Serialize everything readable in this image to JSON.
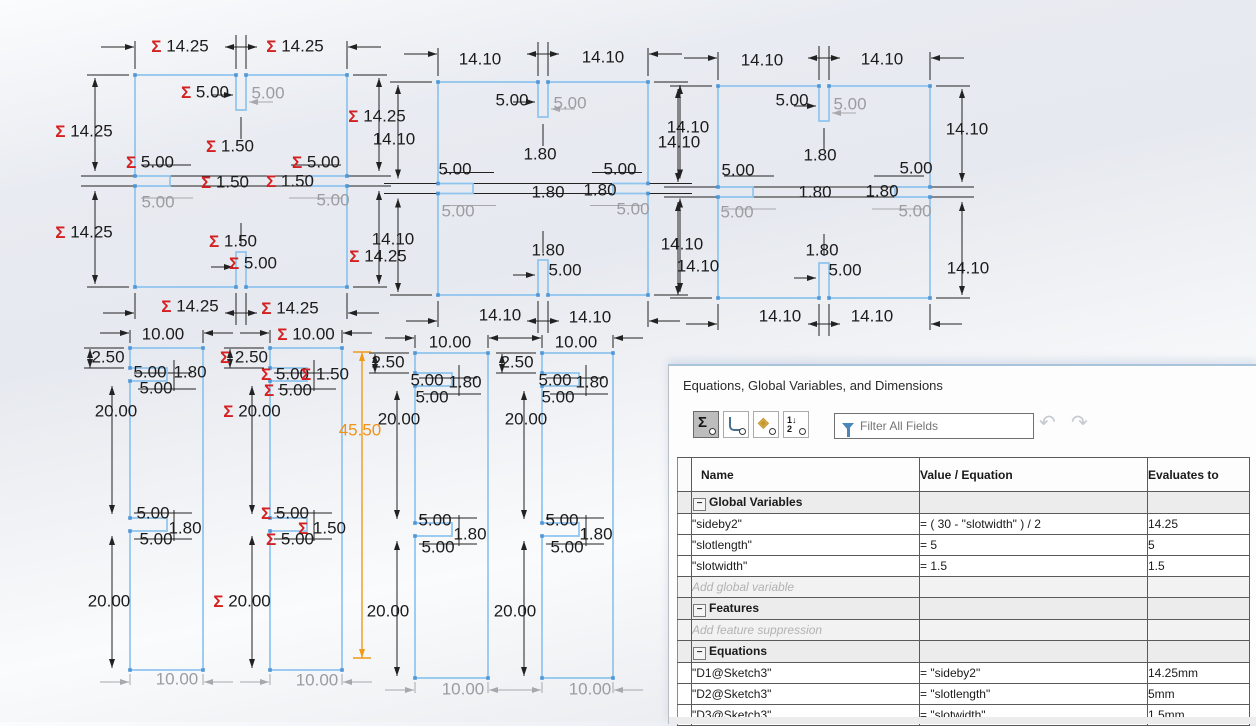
{
  "sketch": {
    "colors": {
      "sketch_blue": "#8fc4ee",
      "dim_black": "#222222",
      "dim_gray": "#a8a8ac",
      "sigma_red": "#d42020",
      "driven_orange": "#ef9318"
    },
    "squares": [
      {
        "x": 135,
        "y": 75,
        "w": 212,
        "h": 212
      },
      {
        "x": 438,
        "y": 82,
        "w": 210,
        "h": 213
      },
      {
        "x": 718,
        "y": 86,
        "w": 212,
        "h": 212
      }
    ],
    "columns": [
      {
        "x": 130,
        "y": 348,
        "w": 73,
        "h": 322
      },
      {
        "x": 270,
        "y": 348,
        "w": 72,
        "h": 322
      },
      {
        "x": 415,
        "y": 353,
        "w": 73,
        "h": 325
      },
      {
        "x": 542,
        "y": 353,
        "w": 71,
        "h": 325
      }
    ],
    "extra_lines": [
      [
        362,
        352,
        362,
        658,
        3,
        "o"
      ],
      [
        353,
        352,
        371,
        352,
        0,
        "o"
      ],
      [
        353,
        658,
        371,
        658,
        0,
        "o"
      ]
    ],
    "labels": [
      [
        180,
        46,
        "14.25",
        "s"
      ],
      [
        295,
        46,
        "14.25",
        "s"
      ],
      [
        205,
        92,
        "5.00",
        "s"
      ],
      [
        268,
        93,
        "5.00",
        "g"
      ],
      [
        84,
        131,
        "14.25",
        "s"
      ],
      [
        150,
        162,
        "5.00",
        "s"
      ],
      [
        230,
        146,
        "1.50",
        "s"
      ],
      [
        316,
        162,
        "5.00",
        "s"
      ],
      [
        225,
        182,
        "1.50",
        "s"
      ],
      [
        290,
        181,
        "1.50",
        "s"
      ],
      [
        158,
        202,
        "5.00",
        "g"
      ],
      [
        333,
        200,
        "5.00",
        "g"
      ],
      [
        84,
        232,
        "14.25",
        "s"
      ],
      [
        233,
        241,
        "1.50",
        "s"
      ],
      [
        253,
        263,
        "5.00",
        "s"
      ],
      [
        190,
        306,
        "14.25",
        "s"
      ],
      [
        290,
        308,
        "14.25",
        "s"
      ],
      [
        377,
        116,
        "14.25",
        "s"
      ],
      [
        394,
        139,
        "14.10",
        "k"
      ],
      [
        393,
        239,
        "14.10",
        "k"
      ],
      [
        378,
        256,
        "14.25",
        "s"
      ],
      [
        480,
        59,
        "14.10",
        "k"
      ],
      [
        603,
        57,
        "14.10",
        "k"
      ],
      [
        512,
        100,
        "5.00",
        "k"
      ],
      [
        570,
        103,
        "5.00",
        "g"
      ],
      [
        540,
        154,
        "1.80",
        "k"
      ],
      [
        455,
        169,
        "5.00",
        "k"
      ],
      [
        620,
        169,
        "5.00",
        "k"
      ],
      [
        548,
        192,
        "1.80",
        "k"
      ],
      [
        600,
        190,
        "1.80",
        "k"
      ],
      [
        458,
        211,
        "5.00",
        "g"
      ],
      [
        633,
        209,
        "5.00",
        "g"
      ],
      [
        548,
        250,
        "1.80",
        "k"
      ],
      [
        565,
        270,
        "5.00",
        "k"
      ],
      [
        500,
        315,
        "14.10",
        "k"
      ],
      [
        590,
        317,
        "14.10",
        "k"
      ],
      [
        688,
        127,
        "14.10",
        "k"
      ],
      [
        679,
        142,
        "14.10",
        "k"
      ],
      [
        682,
        244,
        "14.10",
        "k"
      ],
      [
        698,
        266,
        "14.10",
        "k"
      ],
      [
        762,
        60,
        "14.10",
        "k"
      ],
      [
        882,
        59,
        "14.10",
        "k"
      ],
      [
        792,
        100,
        "5.00",
        "k"
      ],
      [
        850,
        104,
        "5.00",
        "g"
      ],
      [
        820,
        155,
        "1.80",
        "k"
      ],
      [
        738,
        170,
        "5.00",
        "k"
      ],
      [
        916,
        168,
        "5.00",
        "k"
      ],
      [
        815,
        192,
        "1.80",
        "k"
      ],
      [
        882,
        191,
        "1.80",
        "k"
      ],
      [
        737,
        212,
        "5.00",
        "g"
      ],
      [
        915,
        211,
        "5.00",
        "g"
      ],
      [
        822,
        250,
        "1.80",
        "k"
      ],
      [
        845,
        270,
        "5.00",
        "k"
      ],
      [
        780,
        316,
        "14.10",
        "k"
      ],
      [
        872,
        316,
        "14.10",
        "k"
      ],
      [
        967,
        129,
        "14.10",
        "k"
      ],
      [
        968,
        268,
        "14.10",
        "k"
      ],
      [
        163,
        334,
        "10.00",
        "k"
      ],
      [
        108,
        357,
        "2.50",
        "k"
      ],
      [
        150,
        372,
        "5.00",
        "k"
      ],
      [
        190,
        372,
        "1.80",
        "k"
      ],
      [
        156,
        388,
        "5.00",
        "k"
      ],
      [
        116,
        411,
        "20.00",
        "k"
      ],
      [
        153,
        513,
        "5.00",
        "k"
      ],
      [
        185,
        528,
        "1.80",
        "k"
      ],
      [
        156,
        539,
        "5.00",
        "k"
      ],
      [
        109,
        601,
        "20.00",
        "k"
      ],
      [
        177,
        679,
        "10.00",
        "g"
      ],
      [
        306,
        334,
        "10.00",
        "s"
      ],
      [
        244,
        357,
        "2.50",
        "s"
      ],
      [
        285,
        374,
        "5.00",
        "s"
      ],
      [
        325,
        374,
        "1.50",
        "s"
      ],
      [
        288,
        390,
        "5.00",
        "s"
      ],
      [
        252,
        411,
        "20.00",
        "s"
      ],
      [
        285,
        513,
        "5.00",
        "s"
      ],
      [
        322,
        528,
        "1.50",
        "s"
      ],
      [
        290,
        539,
        "5.00",
        "s"
      ],
      [
        242,
        601,
        "20.00",
        "s"
      ],
      [
        317,
        680,
        "10.00",
        "g"
      ],
      [
        450,
        342,
        "10.00",
        "k"
      ],
      [
        388,
        362,
        "2.50",
        "k"
      ],
      [
        427,
        380,
        "5.00",
        "k"
      ],
      [
        465,
        382,
        "1.80",
        "k"
      ],
      [
        432,
        397,
        "5.00",
        "k"
      ],
      [
        399,
        419,
        "20.00",
        "k"
      ],
      [
        435,
        520,
        "5.00",
        "k"
      ],
      [
        470,
        534,
        "1.80",
        "k"
      ],
      [
        438,
        547,
        "5.00",
        "k"
      ],
      [
        388,
        611,
        "20.00",
        "k"
      ],
      [
        463,
        689,
        "10.00",
        "g"
      ],
      [
        576,
        342,
        "10.00",
        "k"
      ],
      [
        517,
        362,
        "2.50",
        "k"
      ],
      [
        555,
        380,
        "5.00",
        "k"
      ],
      [
        592,
        382,
        "1.80",
        "k"
      ],
      [
        558,
        397,
        "5.00",
        "k"
      ],
      [
        526,
        419,
        "20.00",
        "k"
      ],
      [
        562,
        520,
        "5.00",
        "k"
      ],
      [
        596,
        534,
        "1.80",
        "k"
      ],
      [
        567,
        547,
        "5.00",
        "k"
      ],
      [
        515,
        611,
        "20.00",
        "k"
      ],
      [
        590,
        689,
        "10.00",
        "g"
      ],
      [
        360,
        430,
        "45.50",
        "o"
      ]
    ]
  },
  "dialog": {
    "title": "Equations, Global Variables, and Dimensions",
    "toolbar": {
      "buttons": [
        {
          "name": "equation-view",
          "glyph": "Σ",
          "pressed": true
        },
        {
          "name": "dimension-view",
          "glyph": "",
          "pressed": false
        },
        {
          "name": "ordered-view",
          "glyph": "◈",
          "pressed": false
        },
        {
          "name": "sorted-view",
          "glyph": "1↓\n2",
          "pressed": false
        }
      ],
      "filter_placeholder": "Filter All Fields",
      "undo_glyph": "↶",
      "redo_glyph": "↷"
    },
    "table": {
      "collapse_glyph": "−",
      "columns": [
        "Name",
        "Value / Equation",
        "Evaluates to"
      ],
      "rows": [
        {
          "type": "group",
          "name": "Global Variables",
          "value": "",
          "evaluates": ""
        },
        {
          "type": "item",
          "name": "\"sideby2\"",
          "value": "= ( 30 - \"slotwidth\" ) / 2",
          "evaluates": "14.25"
        },
        {
          "type": "item",
          "name": "\"slotlength\"",
          "value": "= 5",
          "evaluates": "5"
        },
        {
          "type": "item",
          "name": "\"slotwidth\"",
          "value": "= 1.5",
          "evaluates": "1.5"
        },
        {
          "type": "placeholder",
          "name": "Add global variable",
          "value": "",
          "evaluates": ""
        },
        {
          "type": "group",
          "name": "Features",
          "value": "",
          "evaluates": ""
        },
        {
          "type": "placeholder",
          "name": "Add feature suppression",
          "value": "",
          "evaluates": ""
        },
        {
          "type": "group",
          "name": "Equations",
          "value": "",
          "evaluates": ""
        },
        {
          "type": "item",
          "name": "\"D1@Sketch3\"",
          "value": "= \"sideby2\"",
          "evaluates": "14.25mm"
        },
        {
          "type": "item",
          "name": "\"D2@Sketch3\"",
          "value": "= \"slotlength\"",
          "evaluates": "5mm"
        },
        {
          "type": "item",
          "name": "\"D3@Sketch3\"",
          "value": "= \"slotwidth\"",
          "evaluates": "1.5mm"
        }
      ]
    }
  }
}
